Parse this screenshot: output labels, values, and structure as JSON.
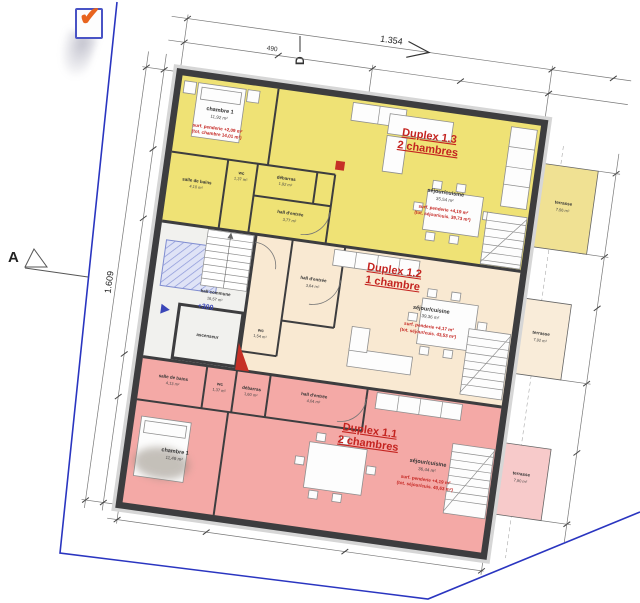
{
  "icon": {
    "check_glyph": "✔"
  },
  "markers": {
    "section_a": "A",
    "section_d": "D"
  },
  "dims": {
    "top_total": "1.354",
    "top_partial": "490",
    "left_total": "1.609",
    "level_mark": "+300"
  },
  "core": {
    "hall_label": "hall commune",
    "hall_area": "16,57 m²",
    "elevator_label": "ascenseur"
  },
  "apartments": {
    "d13": {
      "title": "Duplex 1.3",
      "subtitle": "2 chambres",
      "sejour_label": "séjour/cuisine",
      "sejour_area": "35,54 m²",
      "sejour_note1": "surf. penderie +4,19 m²",
      "sejour_note2": "(tot. séjour/cuis. 39,73 m²)",
      "chambre_label": "chambre 1",
      "chambre_area": "11,92 m²",
      "chambre_note1": "surf. penderie +2,09 m²",
      "chambre_note2": "(tot. chambre 14,01 m²)",
      "bain_label": "salle de bains",
      "bain_area": "4,10 m²",
      "wc_label": "wc",
      "wc_area": "1,37 m²",
      "debarras_label": "débarras",
      "debarras_area": "1,92 m²",
      "hall_label": "hall d'entrée",
      "hall_area": "3,77 m²",
      "terrace_label": "terrasse",
      "terrace_area": "7,56 m²"
    },
    "d12": {
      "title": "Duplex 1.2",
      "subtitle": "1 chambre",
      "sejour_label": "séjour/cuisine",
      "sejour_area": "39,36 m²",
      "sejour_note1": "surf. penderie +4,17 m²",
      "sejour_note2": "(tot. séjour/cuis. 43,53 m²)",
      "hall_label": "hall d'entrée",
      "hall_area": "3,64 m²",
      "wc_label": "wc",
      "wc_area": "1,54 m²",
      "terrace_label": "terrasse",
      "terrace_area": "7,92 m²"
    },
    "d11": {
      "title": "Duplex 1.1",
      "subtitle": "2 chambres",
      "sejour_label": "séjour/cuisine",
      "sejour_area": "36,44 m²",
      "sejour_note1": "surf. penderie +4,19 m²",
      "sejour_note2": "(tot. séjour/cuis. 40,63 m²)",
      "chambre_label": "chambre 1",
      "chambre_area": "11,49 m²",
      "bain_label": "salle de bains",
      "bain_area": "4,13 m²",
      "wc_label": "wc",
      "wc_area": "1,37 m²",
      "debarras_label": "débarras",
      "debarras_area": "1,60 m²",
      "hall_label": "hall d'entrée",
      "hall_area": "4,04 m²",
      "terrace_label": "terrasse",
      "terrace_area": "7,90 m²"
    }
  },
  "colors": {
    "duplex13_fill": "#efe275",
    "duplex12_fill": "#f9e9d2",
    "duplex11_fill": "#f4a9a6",
    "terrace13_fill": "#f0e193",
    "terrace12_fill": "#f9ecd9",
    "terrace11_fill": "#f7caca",
    "core_fill": "#f1f1ee",
    "wall": "#3d3d3f",
    "title_red": "#c42420",
    "boundary_blue": "#2a35c0",
    "elevator_hatch": "#8a96d8"
  }
}
